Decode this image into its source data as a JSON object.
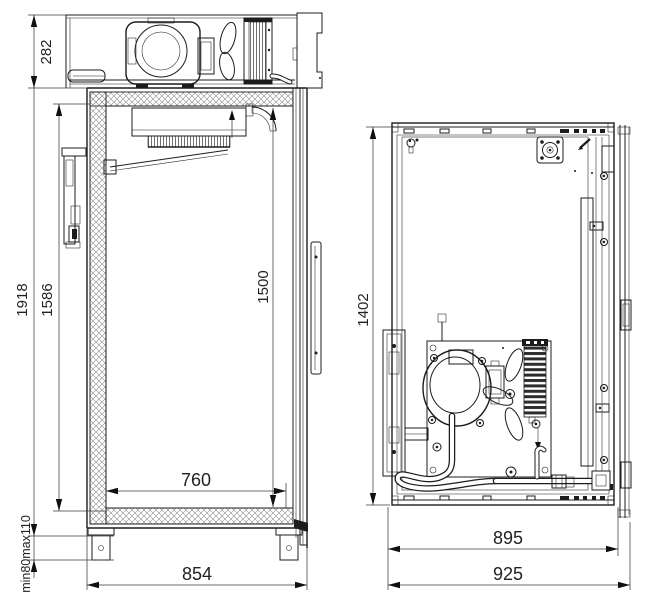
{
  "drawing": {
    "type": "technical-dimension-drawing",
    "subject": "refrigerated cabinet, two orthographic views",
    "units": "mm",
    "side_view": {
      "dims": {
        "machinery_height": "282",
        "overall_height": "1918",
        "interior_height": "1586",
        "door_opening_height": "1500",
        "interior_width": "760",
        "overall_width": "854",
        "leg_height": "min80max110"
      }
    },
    "rear_view": {
      "dims": {
        "body_height": "1402",
        "body_width": "895",
        "overall_width": "925"
      }
    }
  }
}
